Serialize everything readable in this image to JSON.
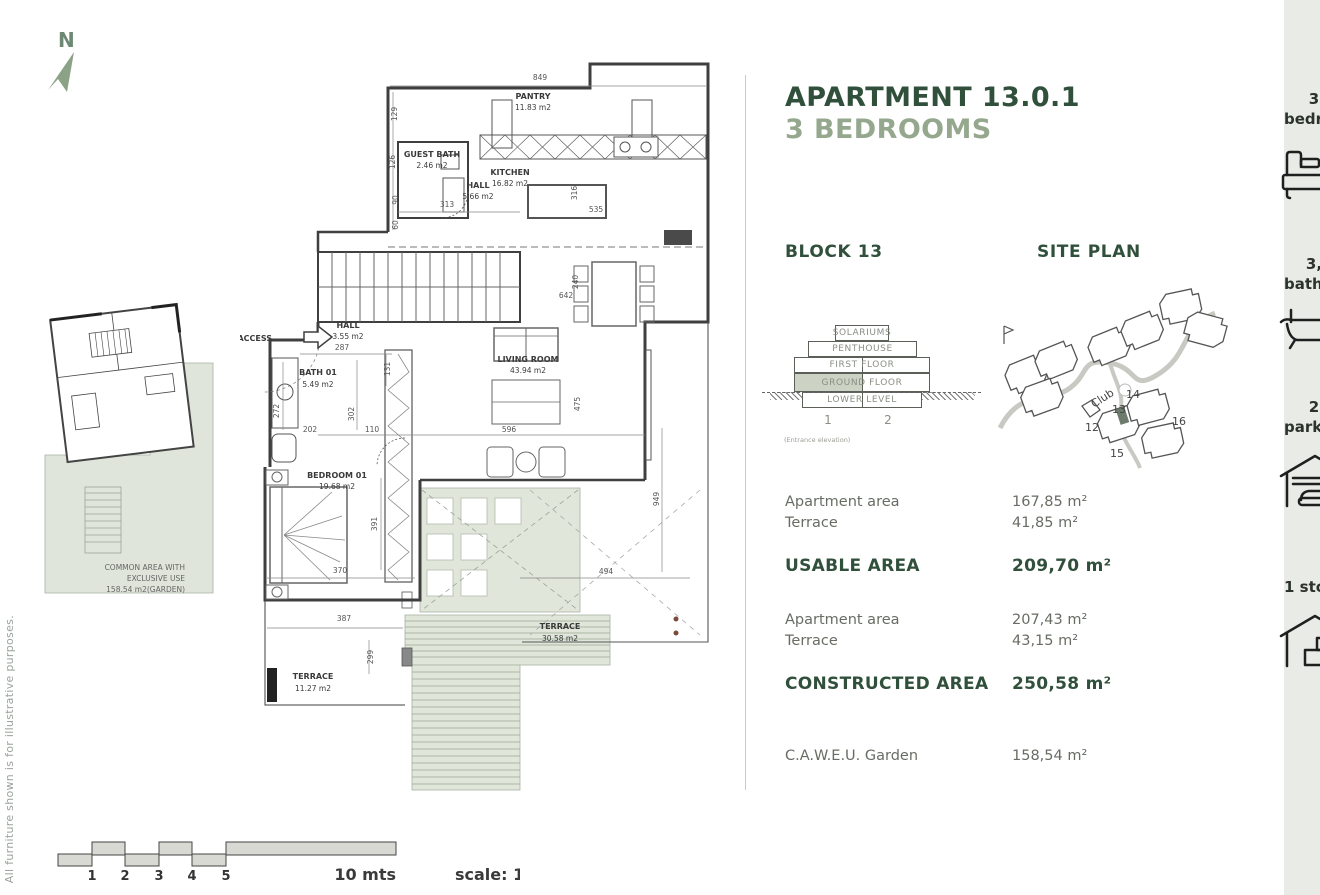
{
  "side_note": "All furniture shown is for illustrative purposes.",
  "compass": {
    "label": "N"
  },
  "header": {
    "title": "APARTMENT 13.0.1",
    "subtitle": "3 BEDROOMS",
    "title_color": "#31503c",
    "subtitle_color": "#95a88e"
  },
  "block": {
    "heading": "BLOCK 13",
    "levels": [
      "SOLARIUMS",
      "PENTHOUSE",
      "FIRST FLOOR",
      "GROUND FLOOR",
      "LOWER LEVEL"
    ],
    "highlighted_level": "GROUND FLOOR",
    "unit_labels": [
      "1",
      "2"
    ],
    "caption": "(Entrance elevation)"
  },
  "site_plan": {
    "heading": "SITE PLAN",
    "labels": {
      "club": "Club",
      "b12": "12",
      "b13": "13",
      "b14": "14",
      "b15": "15",
      "b16": "16"
    }
  },
  "areas": {
    "usable": {
      "rows": [
        {
          "label": "Apartment area",
          "value": "167,85 m²"
        },
        {
          "label": "Terrace",
          "value": "41,85 m²"
        }
      ],
      "total_label": "USABLE AREA",
      "total_value": "209,70 m²"
    },
    "constructed": {
      "rows": [
        {
          "label": "Apartment area",
          "value": "207,43 m²"
        },
        {
          "label": "Terrace",
          "value": "43,15 m²"
        }
      ],
      "total_label": "CONSTRUCTED AREA",
      "total_value": "250,58 m²"
    },
    "garden": {
      "label": "C.A.W.E.U. Garden",
      "value": "158,54 m²"
    }
  },
  "features": [
    {
      "name": "bedrooms",
      "count": "3",
      "label": "bedrooms",
      "icon": "bed-icon"
    },
    {
      "name": "bathrooms",
      "count": "3,",
      "label": "bathrooms",
      "icon": "bathtub-icon"
    },
    {
      "name": "parking",
      "count": "2",
      "label": "parking",
      "icon": "garage-car-icon"
    },
    {
      "name": "storage",
      "count": "1",
      "label": "storage",
      "icon": "garage-storage-icon"
    }
  ],
  "floor_plan": {
    "rooms": [
      {
        "name": "PANTRY",
        "area": "11.83 m2"
      },
      {
        "name": "GUEST BATH",
        "area": "2.46 m2"
      },
      {
        "name": "HALL",
        "area": "5.66 m2"
      },
      {
        "name": "KITCHEN",
        "area": "16.82 m2"
      },
      {
        "name": "HALL",
        "area": "3.55 m2"
      },
      {
        "name": "LIVING ROOM",
        "area": "43.94 m2"
      },
      {
        "name": "BATH 01",
        "area": "5.49 m2"
      },
      {
        "name": "BEDROOM 01",
        "area": "19.68 m2"
      },
      {
        "name": "TERRACE",
        "area": "30.58 m2"
      },
      {
        "name": "TERRACE",
        "area": "11.27 m2"
      }
    ],
    "access_label": "ACCESS",
    "common_area": [
      "COMMON AREA WITH",
      "EXCLUSIVE USE",
      "158.54 m2(GARDEN)"
    ],
    "dims": [
      "849",
      "129",
      "313",
      "90",
      "60",
      "316",
      "535",
      "126",
      "642",
      "240",
      "287",
      "131",
      "302",
      "202",
      "110",
      "596",
      "475",
      "272",
      "391",
      "370",
      "387",
      "299",
      "494",
      "949"
    ]
  },
  "scale_bar": {
    "ticks": [
      "1",
      "2",
      "3",
      "4",
      "5"
    ],
    "length_label": "10 mts",
    "scale_label": "scale: 1/100"
  }
}
